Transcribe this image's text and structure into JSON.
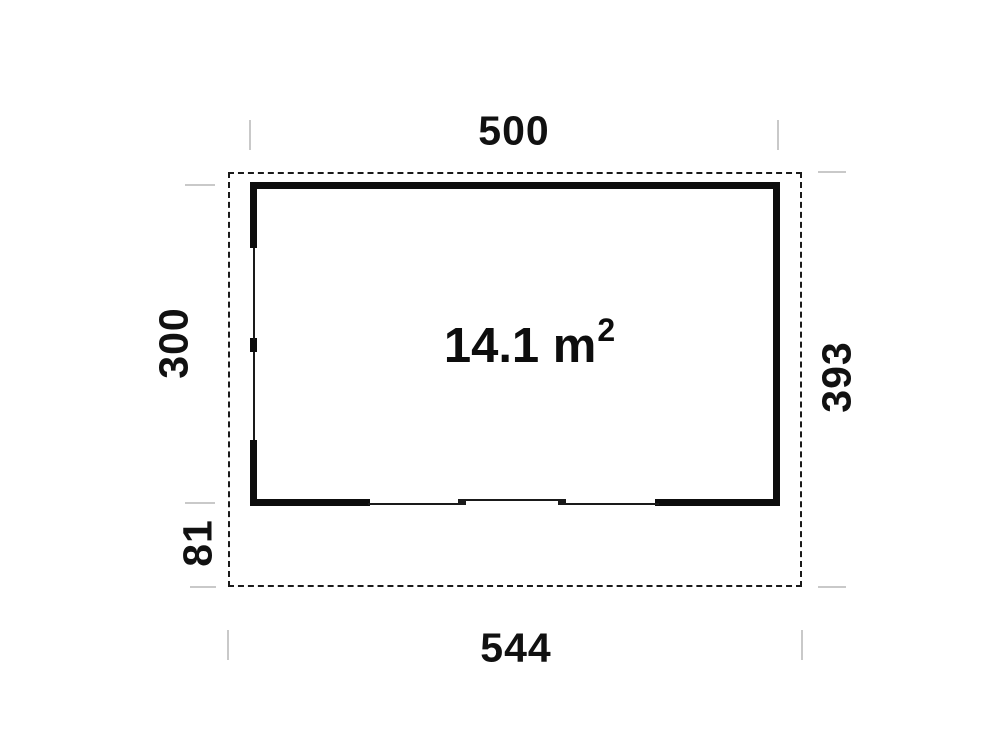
{
  "diagram": {
    "type": "floor-plan",
    "area": {
      "value": "14.1 m",
      "superscript": "2"
    },
    "dimensions": {
      "wall_width_top": "500",
      "wall_height_left": "300",
      "total_height_right": "393",
      "total_width_bottom": "544",
      "porch_depth": "81"
    },
    "colors": {
      "wall": "#0d0d0d",
      "boundary_dash": "#1a1a1a",
      "tick": "#c9c9c9",
      "background": "#ffffff",
      "text": "#111111"
    }
  }
}
